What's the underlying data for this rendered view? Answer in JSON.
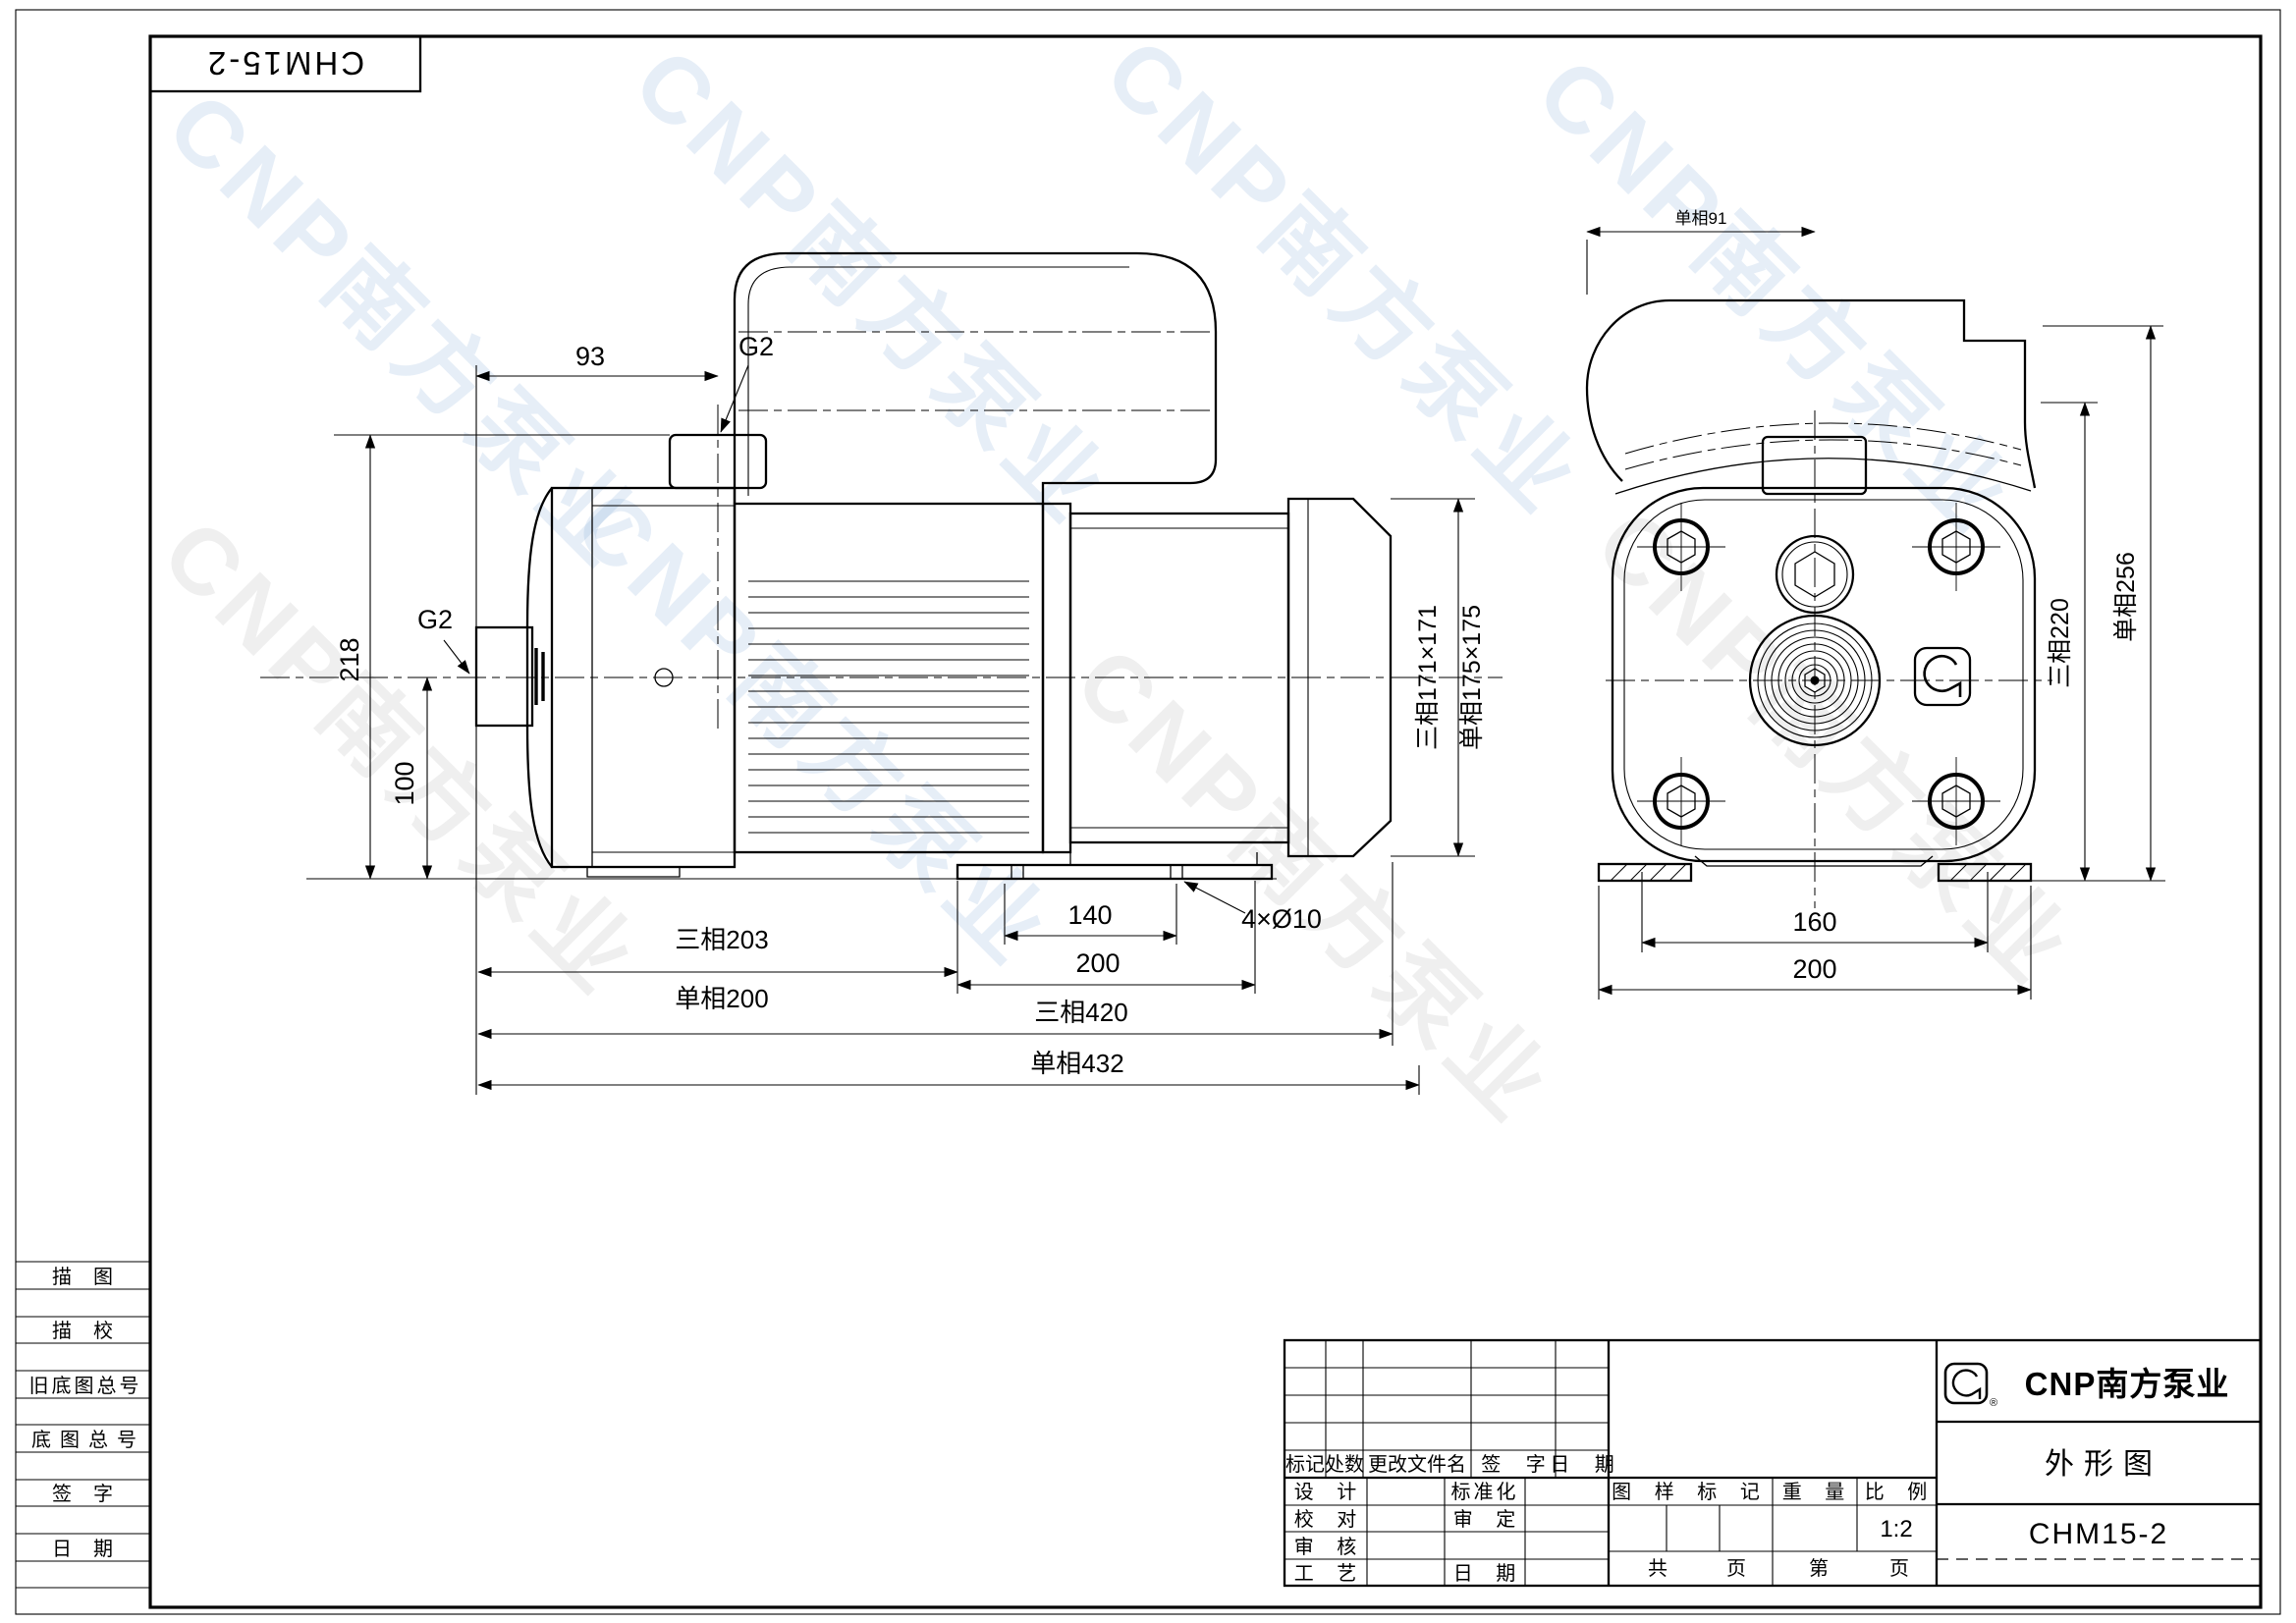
{
  "corner": {
    "model": "CHM15-2"
  },
  "watermark": {
    "text": "CNP南方泵业"
  },
  "side_view": {
    "dim_93": "93",
    "outlet_label": "G2",
    "inlet_label": "G2",
    "dim_218": "218",
    "dim_100": "100",
    "dim_len_3ph": "三相203",
    "dim_len_1ph": "单相200",
    "dim_140": "140",
    "dim_200": "200",
    "bolt_note": "4×Ø10",
    "dim_total_3ph": "三相420",
    "dim_total_1ph": "单相432",
    "dim_flange_3ph": "三相171×171",
    "dim_flange_1ph": "单相175×175"
  },
  "front_view": {
    "dim_91_1ph": "单相91",
    "dim_h_3ph": "三相220",
    "dim_h_1ph": "单相256",
    "dim_160": "160",
    "dim_200": "200"
  },
  "margin_table": {
    "rows": [
      "描图",
      "描校",
      "旧底图总号",
      "底图总号",
      "签字",
      "日期"
    ]
  },
  "title_block": {
    "rev_header": {
      "mark": "标记",
      "count": "处数",
      "file": "更改文件名",
      "sign": "签 字",
      "date": "日 期"
    },
    "roles": {
      "design": "设 计",
      "standardize": "标准化",
      "check": "校 对",
      "approve": "审 定",
      "review": "审 核",
      "craft": "工 艺",
      "date": "日 期"
    },
    "stamp": {
      "mark": "图 样 标 记",
      "weight": "重 量",
      "scale": "比 例",
      "scale_value": "1:2"
    },
    "pages": {
      "total": "共",
      "total_unit": "页",
      "page": "第",
      "page_unit": "页"
    },
    "brand": {
      "cnp": "CNP南方泵业",
      "reg": "®"
    },
    "doc_title": "外形图",
    "model": "CHM15-2"
  }
}
